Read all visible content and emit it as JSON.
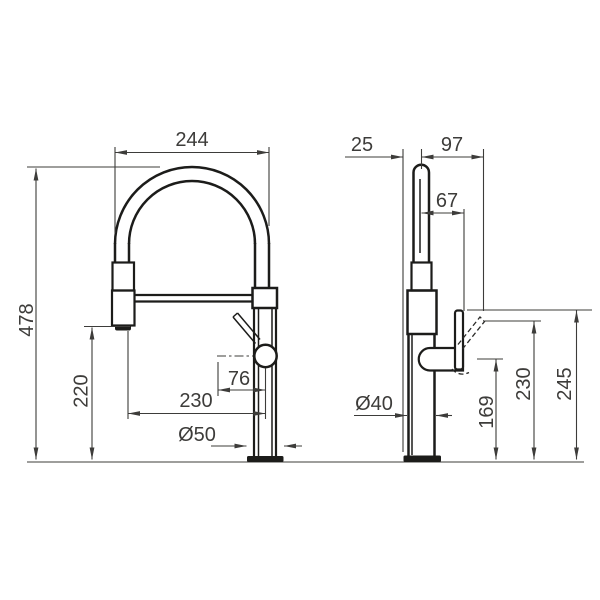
{
  "front_view": {
    "labels": {
      "arc_width": "244",
      "total_height": "478",
      "outlet_height": "220",
      "reach": "230",
      "outlet_offset": "76",
      "base_diameter": "Ø50"
    }
  },
  "side_view": {
    "labels": {
      "back_offset": "25",
      "front_reach": "97",
      "handle_offset": "67",
      "body_diameter": "Ø40",
      "body_height": "169",
      "handle_tilted_height": "230",
      "total_height": "245"
    }
  },
  "colors": {
    "object_line": "#1c1c1a",
    "dimension_line": "#3d3c3a",
    "background": "#ffffff"
  }
}
